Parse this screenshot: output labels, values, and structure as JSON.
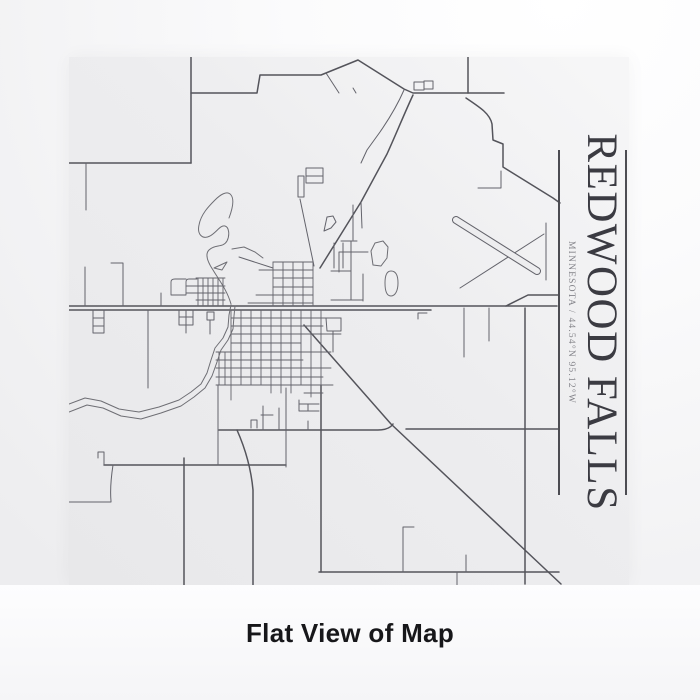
{
  "product": {
    "title": "REDWOOD FALLS",
    "subtitle": "MINNESOTA / 44.54°N 95.12°W",
    "caption": "Flat View of Map"
  },
  "colors": {
    "paper": "#ededef",
    "major_road": "#54545b",
    "street": "#63636b",
    "grid": "#63636b",
    "river": "#6e6e74",
    "title_text": "#3b3b42",
    "subtitle_text": "#84848a",
    "rule": "#4c4c52",
    "caption_text": "#17171a"
  },
  "map": {
    "name": "redwood-falls-street-map",
    "viewBox": "68 57 561 528",
    "runway": {
      "x1": 455,
      "y1": 220,
      "x2": 536,
      "y2": 271,
      "outer_w": 8,
      "inner_w": 6
    },
    "layers": [
      {
        "name": "major-roads",
        "stroke": "#54545b",
        "width": 1.5,
        "paths": [
          "M68,306 H556",
          "M68,310 H430",
          "M505,306 L527,295 H557",
          "M303,325 L390,424 L560,584",
          "M218,430 H377 Q388,430 392,424",
          "M318,572 H558",
          "M190,57 V163",
          "M190,163 H68",
          "M190,93 H256 L259,75 H320 L357,60 L403,89 L412,93 H503",
          "M467,57 V93",
          "M412,95 C404,112 396,132 386,154 L360,202 L319,268",
          "M465,98 C480,108 489,114 491,124 L492,140 L502,144 V167 L552,198 L559,203",
          "M103,465 H285",
          "M183,458 V585",
          "M236,430 C244,448 250,468 252,490 V585",
          "M320,385 V572",
          "M524,308 V584",
          "M405,429 H557"
        ]
      },
      {
        "name": "streets",
        "stroke": "#63636b",
        "width": 1,
        "paths": [
          "M85,163 V210",
          "M84,267 V306",
          "M110,263 H122 V306",
          "M92,310 V333 M103,310 V333 M92,318 H103 M92,326 H103 M92,333 H103",
          "M147,310 V388",
          "M160,293 V306",
          "M178,310 V325 M185,310 V333 M192,310 V325 M178,317 H192 M178,325 H192",
          "M206,312 H213 V320 H206 Z M209,320 V334",
          "M103,465 V452 H97 V458",
          "M112,465 C110,478 109,490 110,501 L110,502 H68",
          "M217,385 V465",
          "M285,388 V467",
          "M262,406 V430 M278,408 V430 M260,415 H272 M250,428 V420 H256 V428",
          "M298,400 V411 M298,404 H318 M298,411 H318 M307,404 V411 M307,421 V430",
          "M402,527 H413 M402,527 V572 M465,555 V572 M456,572 V585",
          "M463,308 V357 M488,308 V341",
          "M417,319 V313 H426",
          "M545,223 V280",
          "M477,188 H500 V171",
          "M403,90 C396,106 388,119 379,132 L366,150 L360,163",
          "M360,202 L361,228 M352,205 V240 M340,241 H356 M333,243 V268 M342,243 V268 M350,241 V271 M338,252 V272 M338,252 H367 M330,271 H350 M350,271 V300 M330,300 H362 M362,274 V301",
          "M299,199 L313,266",
          "M238,257 L272,268",
          "M325,73 L338,93 M352,88 L355,93",
          "M413,82 H423 V90 H413 Z M423,81 H432 V89 H423 Z",
          "M305,168 H322 V176 H305 Z M305,176 H322 V183 H305 Z M297,176 H303 V197 H297 Z",
          "M323,231 L326,217 L332,216 L335,222 L330,228 Z",
          "M325,318 H340 V331 H326 Z M332,331 V352",
          "M459,288 L543,234"
        ]
      },
      {
        "name": "street-grid",
        "stroke": "#63636b",
        "width": 0.9,
        "paths": [
          "M272,262 V306 M282,262 V306 M292,262 V306 M302,262 V306 M312,262 V306",
          "M272,262 H312 M258,270 H312 M272,278 H312 M272,287 H312 M255,295 H312 M247,303 H312",
          "M197,278 V305 M202,278 V305 M207,278 V305 M212,278 V305 M217,278 V305 M222,278 V305",
          "M195,278 H224 M185,286 H224 M185,293 H224 M195,300 H224",
          "M185,295 V282 Q185,279 188,279 H196 M170,295 V282 Q170,279 174,279 H185 M170,295 H185",
          "M230,310 V400 M240,310 V385 M250,310 V385 M260,310 V385 M270,310 V393 M280,310 V393 M290,310 V393 M300,310 V385 M310,310 V397 M320,310 V385 M218,352 V385 M224,352 V385",
          "M230,318 H340 M230,326 H322 M230,334 H340 M230,343 H300 M215,352 H330 M215,360 H302 M215,368 H330 M215,377 H322 M215,385 H332 M303,393 H322"
        ]
      },
      {
        "name": "river",
        "stroke": "#6e6e74",
        "width": 1,
        "paths": [
          "M68,404 L84,398 L100,401 L118,409 L138,412 L158,407 L178,400 L190,392 L200,384 L206,373 L210,360 L214,348 L222,338 L227,327 L228,315 L230,305",
          "M68,412 L86,405 L102,408 L120,416 L140,419 L160,413 L180,406 L193,397 L204,388 L211,376 L216,362 L220,350 L227,340 L232,329 L233,316 L234,306",
          "M230,304 C226,290 218,280 212,270 C206,261 204,254 208,250 C214,244 222,248 226,241 C229,235 228,227 224,226 C219,225 216,232 209,236 C201,240 196,234 198,225 C200,214 208,206 214,200 C219,195 226,190 230,195 C234,200 231,210 228,218",
          "M231,249 L243,247 L254,252 L262,258",
          "M213,268 L226,262 L221,270 Z",
          "M372,265 L370,251 L374,243 L382,241 L387,247 L386,258 L380,266 Z",
          "M390,271 C395,271 397,276 397,283 C397,291 394,296 390,296 C386,296 384,291 384,283 C384,275 386,271 390,271 Z"
        ]
      }
    ]
  }
}
